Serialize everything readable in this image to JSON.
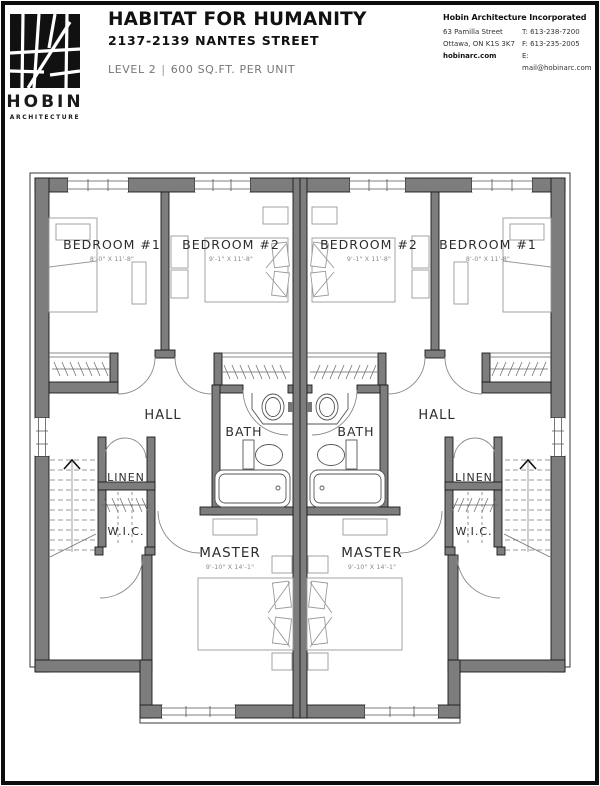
{
  "logo": {
    "name": "HOBIN",
    "subtitle": "ARCHITECTURE"
  },
  "header": {
    "title": "HABITAT FOR HUMANITY",
    "address": "2137-2139 NANTES STREET",
    "level_label": "LEVEL 2",
    "separator": "|",
    "area_label": "600 SQ.FT. PER UNIT"
  },
  "contact": {
    "company": "Hobin Architecture Incorporated",
    "address_line1": "63 Pamilla Street",
    "phone": "T: 613-238-7200",
    "address_line2": "Ottawa, ON  K1S 3K7",
    "fax": "F: 613-235-2005",
    "website": "hobinarc.com",
    "email": "E: mail@hobinarc.com"
  },
  "plan": {
    "rooms": {
      "bedroom1": {
        "label": "BEDROOM #1",
        "dim": "8'-0\" X 11'-8\""
      },
      "bedroom2": {
        "label": "BEDROOM #2",
        "dim": "9'-1\" X 11'-8\""
      },
      "hall": {
        "label": "HALL"
      },
      "bath": {
        "label": "BATH"
      },
      "linen": {
        "label": "LINEN"
      },
      "wic": {
        "label": "W.I.C."
      },
      "master": {
        "label": "MASTER",
        "dim": "9'-10\" X 14'-1\""
      }
    },
    "colors": {
      "wall": "#7d7d7d",
      "wall_edge": "#1a1a1a",
      "outline": "#3a3a3a",
      "furniture": "#9a9a9a",
      "fixture": "#555555",
      "label": "#2d2d2d",
      "dim": "#8a8a8a"
    }
  }
}
